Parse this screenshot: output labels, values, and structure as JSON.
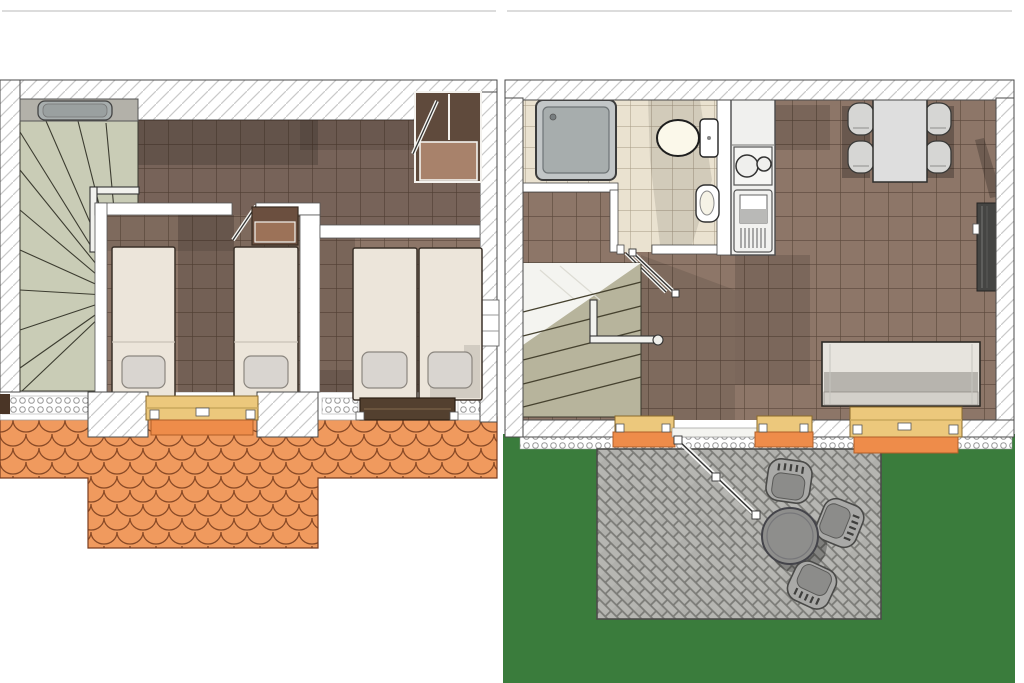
{
  "meta": {
    "type": "architectural-floor-plan",
    "floors": 2,
    "views": [
      "upper-floor-plan",
      "ground-floor-plan"
    ]
  },
  "colors": {
    "background": "#ffffff",
    "wall_outline": "#4a4a4a",
    "wall_hatch": "#c9c9c9",
    "floor_tile": "#8d7668",
    "floor_tile_hall": "#776359",
    "grout": "#45372e",
    "bathroom_tile": "#eae2d0",
    "stairs_upper": "#c9ccb6",
    "stairs_lower": "#b7b49c",
    "roof": "#f09a5e",
    "roof_line": "#8a4a26",
    "sill_yellow": "#ecc87c",
    "sill_orange": "#ee8c4a",
    "bed": "#ece5da",
    "pillow": "#d9d5d0",
    "wood_dark": "#5f4a3c",
    "wood_light": "#a8826b",
    "shower": "#a7adad",
    "fixture": "#fbf8ea",
    "counter": "#f0f0ee",
    "table": "#dedede",
    "chair": "#d6d6d4",
    "sofa_back": "#e7e4de",
    "sofa_seat": "#b7b4ae",
    "sofa_front": "#d3d0ca",
    "grass": "#3a7c3c",
    "paver": "#b6b6b2",
    "paver_joint": "#8b8b87",
    "patio_metal": "#8e8e8c",
    "patio_chair": "#a9a9a7",
    "heater": "#454543",
    "window_glass": "#f4f4f0"
  },
  "upper_floor": {
    "elements": [
      "winder staircase",
      "washbasin counter",
      "hallway",
      "corner wardrobe",
      "bedroom with two single beds",
      "dresser",
      "bedroom with twin beds",
      "dormer window with yellow sill",
      "dark roof window",
      "scalloped tile roof"
    ]
  },
  "ground_floor": {
    "elements": [
      "bathroom",
      "square shower",
      "toilet",
      "small washbasin",
      "kitchenette with two-burner cooktop",
      "refrigerator unit",
      "dining table with four chairs",
      "wall heater",
      "sofa",
      "staircase with handrail",
      "entrance door to patio",
      "three windows with orange sills",
      "garden lawn",
      "gravel strip",
      "paved patio",
      "round patio table with three chairs"
    ]
  }
}
